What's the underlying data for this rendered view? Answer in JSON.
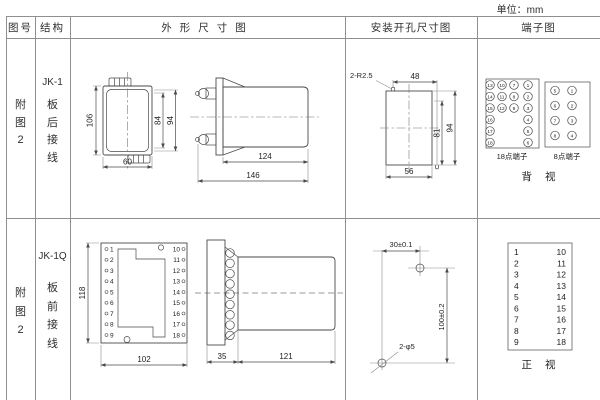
{
  "unit_label": "单位：mm",
  "header": {
    "figure": "图号",
    "structure": "结构",
    "outline": "外形尺寸图",
    "mounting": "安装开孔尺寸图",
    "terminal": "端子图"
  },
  "row1": {
    "figure": "附图2",
    "model": "JK-1",
    "wiring": "板后接线",
    "outline": {
      "front": {
        "height": "106",
        "inner_height": "84",
        "outer_height": "94",
        "width": "60"
      },
      "side": {
        "body_length": "124",
        "total_length": "146"
      }
    },
    "mounting": {
      "slot": "2-R2.5",
      "top_width": "48",
      "inner_height": "81",
      "outer_height": "94",
      "bottom_width": "56"
    },
    "terminal": {
      "block18": {
        "label": "18点端子",
        "rows": [
          [
            "13",
            "10",
            "7",
            "1"
          ],
          [
            "14",
            "11",
            "8",
            "2"
          ],
          [
            "15",
            "12",
            "9",
            "3"
          ],
          [
            "16",
            "",
            "",
            "4"
          ],
          [
            "17",
            "",
            "",
            "5"
          ],
          [
            "18",
            "",
            "",
            "6"
          ]
        ]
      },
      "block8": {
        "label": "8点端子",
        "rows": [
          [
            "5",
            "1"
          ],
          [
            "6",
            "2"
          ],
          [
            "7",
            "3"
          ],
          [
            "8",
            "4"
          ]
        ]
      },
      "view": "背 视"
    }
  },
  "row2": {
    "figure": "附图2",
    "model": "JK-1Q",
    "wiring": "板前接线",
    "outline": {
      "front": {
        "height": "118",
        "width": "102",
        "left_terminals": [
          "1",
          "2",
          "3",
          "4",
          "5",
          "6",
          "7",
          "8",
          "9"
        ],
        "right_terminals": [
          "10",
          "11",
          "12",
          "13",
          "14",
          "15",
          "16",
          "17",
          "18"
        ]
      },
      "side": {
        "panel_depth": "35",
        "body_length": "121"
      }
    },
    "mounting": {
      "hole_spacing_h": "30±0.1",
      "hole_spacing_v": "100±0.2",
      "holes": "2-φ5"
    },
    "terminal": {
      "left": [
        "1",
        "2",
        "3",
        "4",
        "5",
        "6",
        "7",
        "8",
        "9"
      ],
      "right": [
        "10",
        "11",
        "12",
        "13",
        "14",
        "15",
        "16",
        "17",
        "18"
      ],
      "view": "正 视"
    }
  }
}
